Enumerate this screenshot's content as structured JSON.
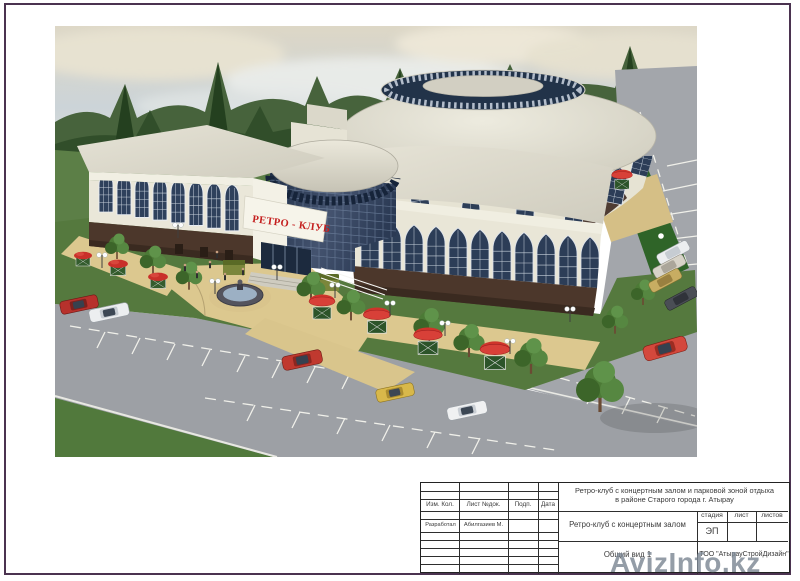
{
  "colors": {
    "sign_red": "#c41e1e",
    "frame_purple": "#4b3350",
    "watermark_gray": "#7d8894",
    "building_cream": "#e9e6d7",
    "glass_blue": "#2c3d57",
    "base_brown": "#4c372b",
    "paving_tan": "#dcc88f",
    "road_gray": "#9da0a5"
  },
  "rendering": {
    "building_sign": "РЕТРО - КЛУБ"
  },
  "watermark": {
    "text": "AvizInfo.kz"
  },
  "title_block": {
    "revision_header": {
      "izm": "Изм. Кол.",
      "list": "Лист №док.",
      "podp": "Подп.",
      "data": "Дата"
    },
    "rows": {
      "role": "Разработал",
      "name": "Абилгазиев М."
    },
    "project_line1": "Ретро-клуб с концертным залом и парковой зоной отдыха",
    "project_line2": "в районе Старого города г. Атырау",
    "object_name": "Ретро-клуб с концертным залом",
    "stage": {
      "label": "стадия",
      "value": "ЭП"
    },
    "sheet_label": "лист",
    "sheets_label": "листов",
    "view_name": "Общий вид 1",
    "company": "ТОО \"АтырауСтройДизайн\""
  }
}
